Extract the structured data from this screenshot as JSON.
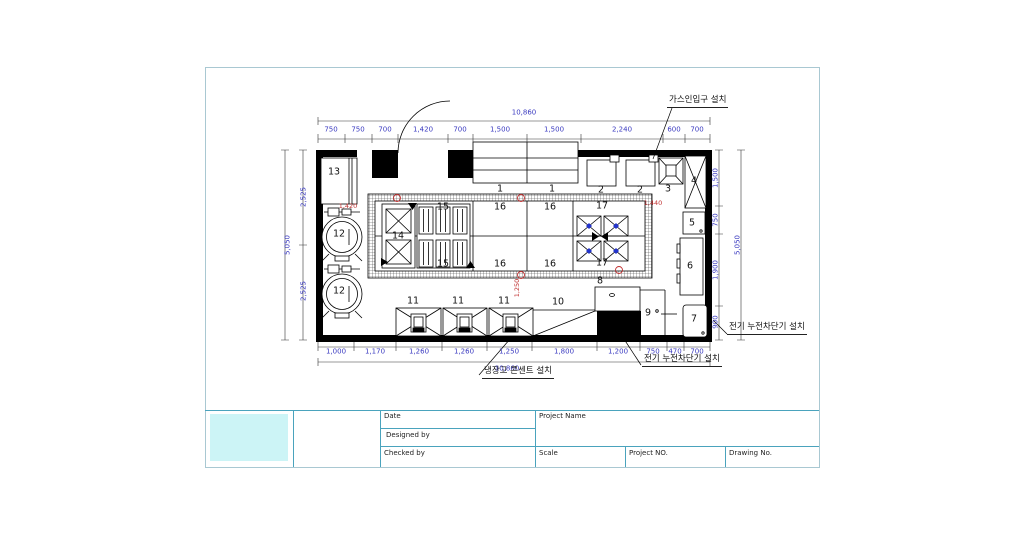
{
  "title_block": {
    "date": "Date",
    "designed_by": "Designed by",
    "checked_by": "Checked by",
    "project_name": "Project Name",
    "scale": "Scale",
    "project_no": "Project NO.",
    "drawing_no": "Drawing No."
  },
  "annotations": {
    "gas_inlet": "가스인입구 설치",
    "breaker_right": "전기 누전차단기 설치",
    "breaker_bottom": "전기 누전차단기 설치",
    "fridge_outlet": "냉장고 콘센트 설치"
  },
  "dimensions": {
    "top_total": "10,860",
    "bottom_total": "10,860",
    "left_total": "5,050",
    "right_total": "5,050",
    "top": [
      {
        "text": "750",
        "x": 331,
        "y": 130
      },
      {
        "text": "750",
        "x": 358,
        "y": 130
      },
      {
        "text": "700",
        "x": 385,
        "y": 130
      },
      {
        "text": "1,420",
        "x": 423,
        "y": 130
      },
      {
        "text": "700",
        "x": 460,
        "y": 130
      },
      {
        "text": "1,500",
        "x": 500,
        "y": 130
      },
      {
        "text": "1,500",
        "x": 554,
        "y": 130
      },
      {
        "text": "2,240",
        "x": 622,
        "y": 130
      },
      {
        "text": "600",
        "x": 674,
        "y": 130
      },
      {
        "text": "700",
        "x": 697,
        "y": 130
      }
    ],
    "bottom": [
      {
        "text": "1,000",
        "x": 336,
        "y": 352
      },
      {
        "text": "1,170",
        "x": 375,
        "y": 352
      },
      {
        "text": "1,260",
        "x": 419,
        "y": 352
      },
      {
        "text": "1,260",
        "x": 464,
        "y": 352
      },
      {
        "text": "1,250",
        "x": 509,
        "y": 352
      },
      {
        "text": "1,800",
        "x": 564,
        "y": 352
      },
      {
        "text": "1,200",
        "x": 618,
        "y": 352
      },
      {
        "text": "750",
        "x": 653,
        "y": 352
      },
      {
        "text": "470",
        "x": 675,
        "y": 352
      },
      {
        "text": "700",
        "x": 697,
        "y": 352
      }
    ],
    "left": [
      {
        "text": "2,525",
        "x": 304,
        "y": 197,
        "rot": -90
      },
      {
        "text": "2,525",
        "x": 304,
        "y": 291,
        "rot": -90
      }
    ],
    "right": [
      {
        "text": "1,500",
        "x": 716,
        "y": 178,
        "rot": -90
      },
      {
        "text": "750",
        "x": 716,
        "y": 220,
        "rot": -90
      },
      {
        "text": "1,900",
        "x": 716,
        "y": 270,
        "rot": -90
      },
      {
        "text": "900",
        "x": 716,
        "y": 322,
        "rot": -90
      }
    ]
  },
  "red_notes": [
    {
      "text": "1,420",
      "x": 348,
      "y": 206
    },
    {
      "text": "1,440",
      "x": 653,
      "y": 203
    },
    {
      "text": "1,250",
      "x": 517,
      "y": 288,
      "rot": -90
    }
  ],
  "item_labels": [
    {
      "text": "13",
      "x": 334,
      "y": 172
    },
    {
      "text": "12",
      "x": 339,
      "y": 234
    },
    {
      "text": "12",
      "x": 339,
      "y": 291
    },
    {
      "text": "14",
      "x": 398,
      "y": 236
    },
    {
      "text": "15",
      "x": 443,
      "y": 207
    },
    {
      "text": "16",
      "x": 500,
      "y": 207
    },
    {
      "text": "16",
      "x": 550,
      "y": 207
    },
    {
      "text": "17",
      "x": 602,
      "y": 206
    },
    {
      "text": "15",
      "x": 443,
      "y": 264
    },
    {
      "text": "16",
      "x": 500,
      "y": 264
    },
    {
      "text": "16",
      "x": 550,
      "y": 264
    },
    {
      "text": "17",
      "x": 602,
      "y": 263
    },
    {
      "text": "1",
      "x": 500,
      "y": 189
    },
    {
      "text": "1",
      "x": 552,
      "y": 189
    },
    {
      "text": "2",
      "x": 601,
      "y": 190
    },
    {
      "text": "2",
      "x": 640,
      "y": 190
    },
    {
      "text": "3",
      "x": 668,
      "y": 189
    },
    {
      "text": "4",
      "x": 694,
      "y": 181
    },
    {
      "text": "5",
      "x": 692,
      "y": 223
    },
    {
      "text": "6",
      "x": 690,
      "y": 266
    },
    {
      "text": "7",
      "x": 694,
      "y": 319
    },
    {
      "text": "8",
      "x": 600,
      "y": 281
    },
    {
      "text": "9",
      "x": 648,
      "y": 313
    },
    {
      "text": "10",
      "x": 558,
      "y": 302
    },
    {
      "text": "11",
      "x": 413,
      "y": 301
    },
    {
      "text": "11",
      "x": 458,
      "y": 301
    },
    {
      "text": "11",
      "x": 504,
      "y": 301
    }
  ],
  "colors": {
    "dimension_text": "#3a3ac0",
    "red_note": "#c03030",
    "title_lines": "#4aa3bd",
    "logo_fill": "#ccf4f6",
    "sheet_border": "#a9c8d2",
    "wall": "#000000"
  }
}
